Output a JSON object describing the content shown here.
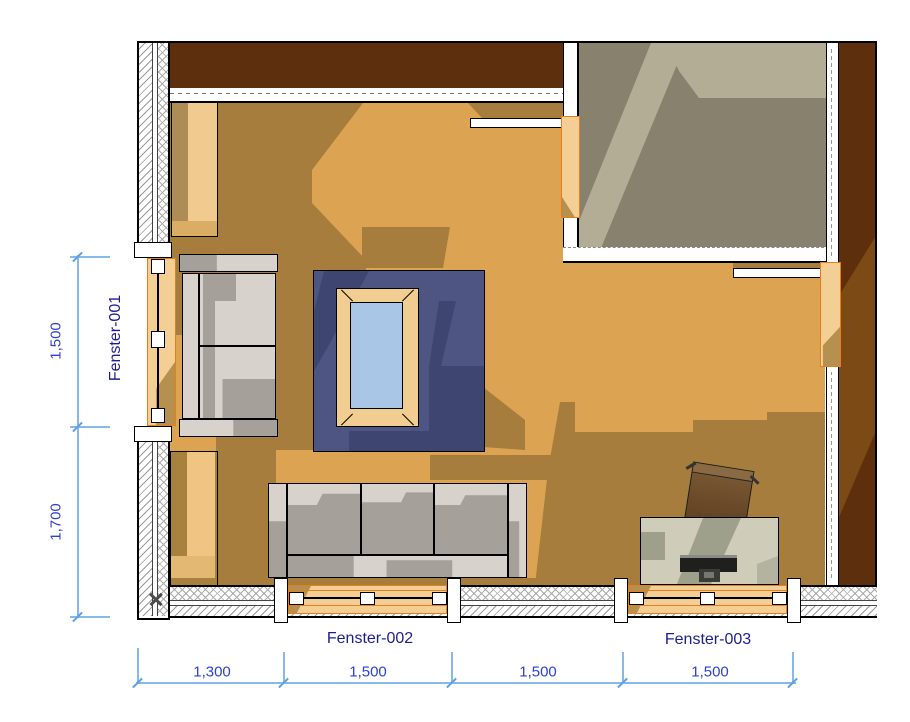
{
  "drawing_type": "floor-plan",
  "windows": [
    {
      "id": "Fenster-001"
    },
    {
      "id": "Fenster-002"
    },
    {
      "id": "Fenster-003"
    }
  ],
  "dimensions": {
    "vertical": [
      {
        "value": "1,500"
      },
      {
        "value": "1,700"
      }
    ],
    "horizontal": [
      {
        "value": "1,300"
      },
      {
        "value": "1,500"
      },
      {
        "value": "1,500"
      },
      {
        "value": "1,500"
      }
    ]
  },
  "colors": {
    "floor_light": "#dca452",
    "floor_shadow": "#a67d3c",
    "adjacent_floor": "#87816d",
    "adjacent_floor_light": "#b3ad95",
    "wall_brown_dark": "#5e2f0c",
    "wall_brown_light": "#7b4a15",
    "rug_blue": "#4e5582",
    "rug_shadow": "#3e4571",
    "table_wood": "#f2cd92",
    "table_glass": "#a9c6e6",
    "sofa_light": "#d7d2cc",
    "sofa_shadow": "#a6a09a",
    "window_frame_orange": "#e87d1a",
    "window_sill_tan": "#f3cf96",
    "desk_top": "#cfccb9",
    "dimension_line": "#86b9ec",
    "dimension_text": "#2e41cf",
    "label_text": "#1d1d92"
  }
}
